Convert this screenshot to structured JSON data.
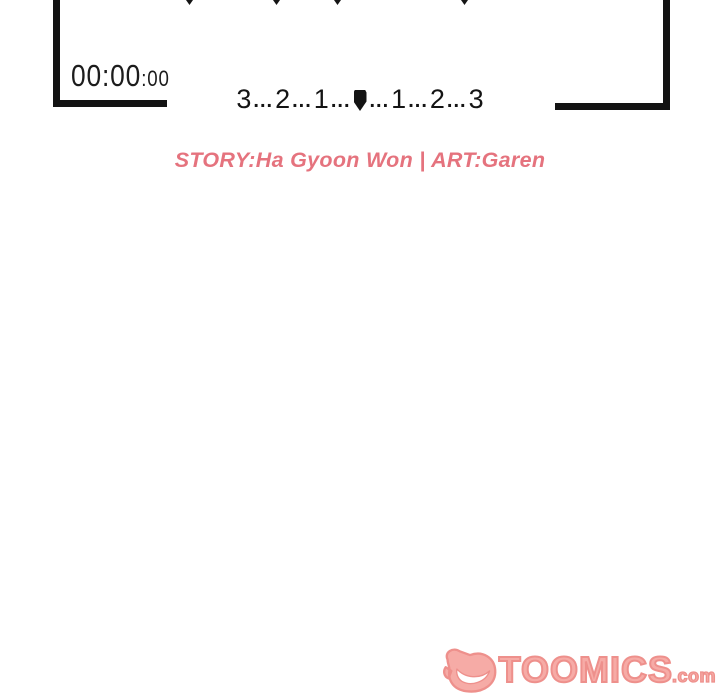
{
  "panel": {
    "border_color": "#131313",
    "timer": {
      "main": "00:00",
      "frames": ":00"
    },
    "countdown": {
      "left": [
        "3",
        "2",
        "1"
      ],
      "right": [
        "1",
        "2",
        "3"
      ],
      "dots": "...",
      "center_marker": "censored-block"
    }
  },
  "credits": {
    "text": "STORY:Ha Gyoon Won | ART:Garen",
    "color": "#e5737e"
  },
  "watermark": {
    "brand": "TOOMICS",
    "tld": ".com",
    "fill_color": "#f6aba6",
    "outline_color": "#ee908c"
  }
}
